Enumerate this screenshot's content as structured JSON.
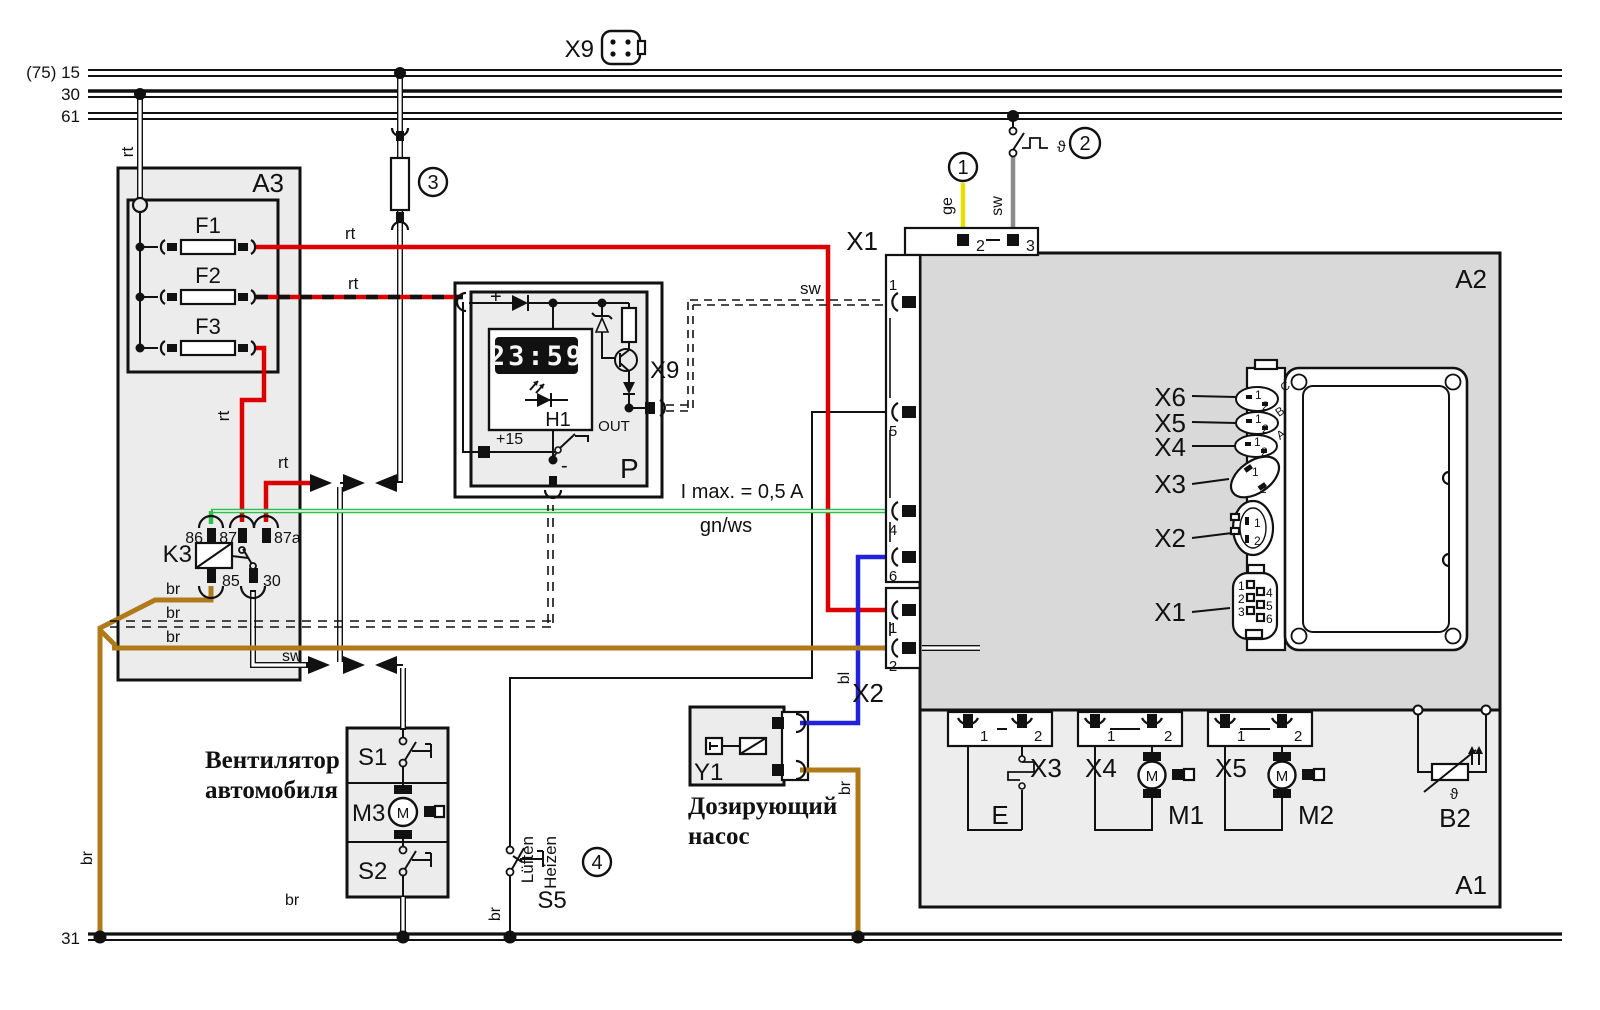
{
  "diagram_type": "wiring-diagram (auxiliary heater / Webasto with dosing pump)",
  "colors": {
    "wire_red": "#dd0000",
    "wire_green": "#2fbf4f",
    "wire_blue": "#2222dd",
    "wire_brown": "#b07a1a",
    "wire_yellow": "#e8e000",
    "wire_gray": "#8c8c8c",
    "module_fill": "#ececec",
    "controller_fill": "#d9d9d9",
    "display_bg": "#111111",
    "display_text": "#f5f5f5"
  },
  "labels": {
    "b15": "(75) 15",
    "b30": "30",
    "b61": "61",
    "b31": "31",
    "x9": "X9",
    "c1": "1",
    "c2": "2",
    "c3": "3",
    "c4": "4",
    "theta": "ϑ",
    "a3": "A3",
    "f1": "F1",
    "f2": "F2",
    "f3": "F3",
    "k3": "K3",
    "p86": "86",
    "p87": "87",
    "p87a": "87a",
    "p85": "85",
    "p30": "30",
    "rt": "rt",
    "sw": "sw",
    "br": "br",
    "ge": "ge",
    "bl": "bl",
    "gnws": "gn/ws",
    "imax": "I max. = 0,5 A",
    "plus": "+",
    "plus15": "+15",
    "minus": "-",
    "out": "OUT",
    "p": "P",
    "h1": "H1",
    "display": "23:59",
    "x1": "X1",
    "x2": "X2",
    "d1": "1",
    "d2": "2",
    "d3": "3",
    "d4": "4",
    "d5": "5",
    "d6": "6",
    "a2": "A2",
    "a1": "A1",
    "x3": "X3",
    "x4": "X4",
    "x5": "X5",
    "x6": "X6",
    "lc": "C",
    "lb": "B",
    "la": "A",
    "e": "E",
    "m": "M",
    "m1": "M1",
    "m2": "M2",
    "b2": "B2",
    "s1": "S1",
    "m3": "M3",
    "s2": "S2",
    "s5": "S5",
    "lueften": "Lüften",
    "heizen": "Heizen",
    "fan_line1": "Вентилятор",
    "fan_line2": "автомобиля",
    "pump_line1": "Дозирующий",
    "pump_line2": "насос"
  }
}
